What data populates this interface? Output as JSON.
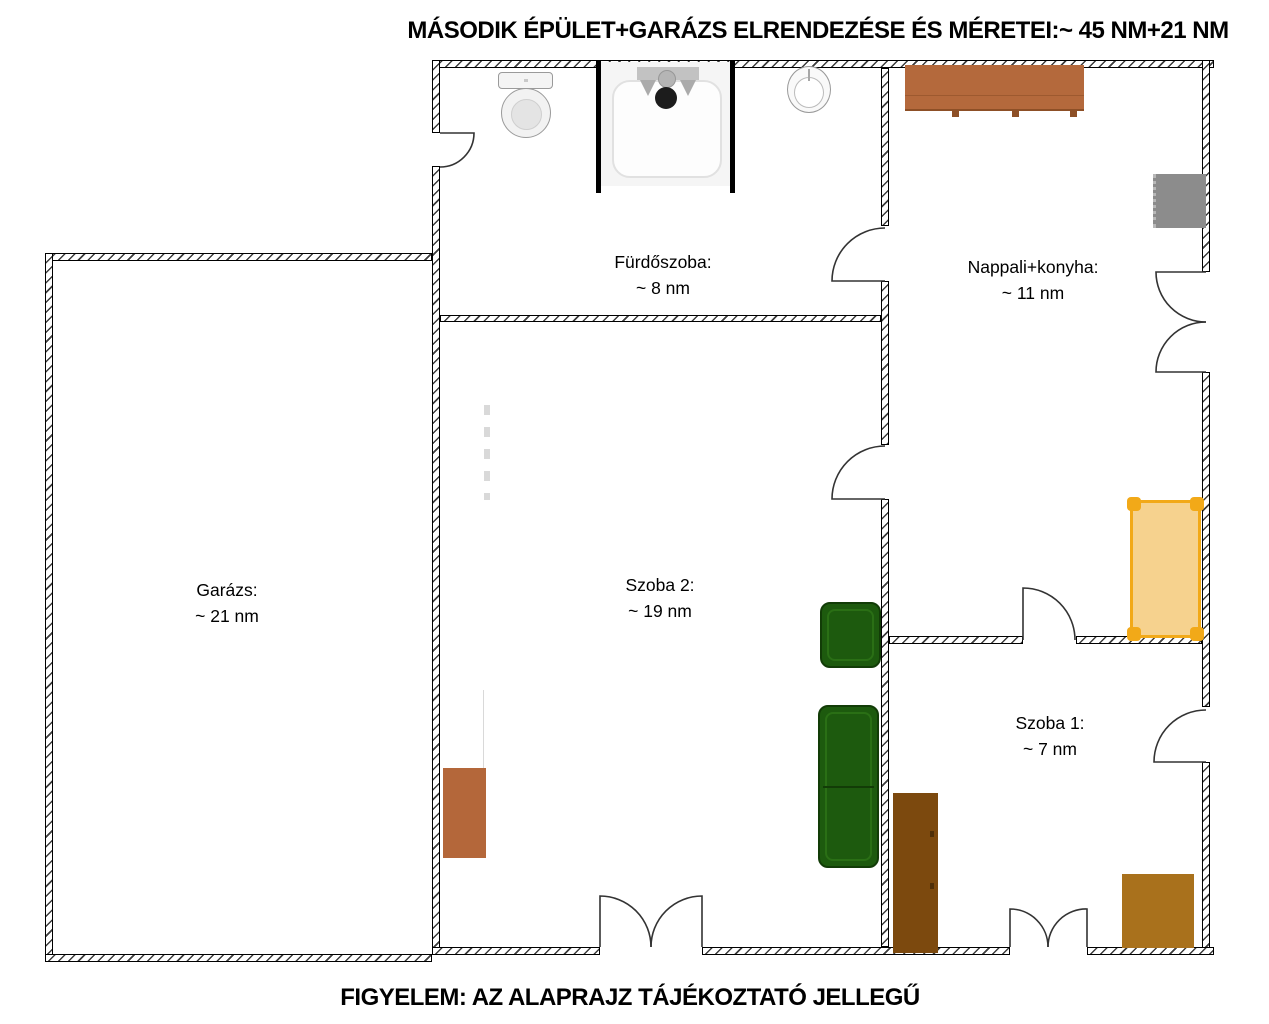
{
  "title": "MÁSODIK ÉPÜLET+GARÁZS ELRENDEZÉSE ÉS MÉRETEI:~ 45 NM+21 NM",
  "footer": "FIGYELEM: AZ ALAPRAJZ TÁJÉKOZTATÓ JELLEGŰ",
  "rooms": [
    {
      "id": "furdoszoba",
      "name": "Fürdőszoba:",
      "area": "~ 8 nm"
    },
    {
      "id": "nappali_konyha",
      "name": "Nappali+konyha:",
      "area": "~ 11 nm"
    },
    {
      "id": "garazs",
      "name": "Garázs:",
      "area": "~ 21 nm"
    },
    {
      "id": "szoba2",
      "name": "Szoba 2:",
      "area": "~ 19 nm"
    },
    {
      "id": "szoba1",
      "name": "Szoba 1:",
      "area": "~ 7 nm"
    }
  ],
  "colors": {
    "counter": "#b4693c",
    "appliance": "#8c8c8c",
    "bed_fill": "#f6d28e",
    "bed_frame": "#f2a918",
    "sofa": "#1d5a0e",
    "cabinet": "#b4673a",
    "wardrobe": "#7c490e",
    "desk": "#a9711c"
  }
}
